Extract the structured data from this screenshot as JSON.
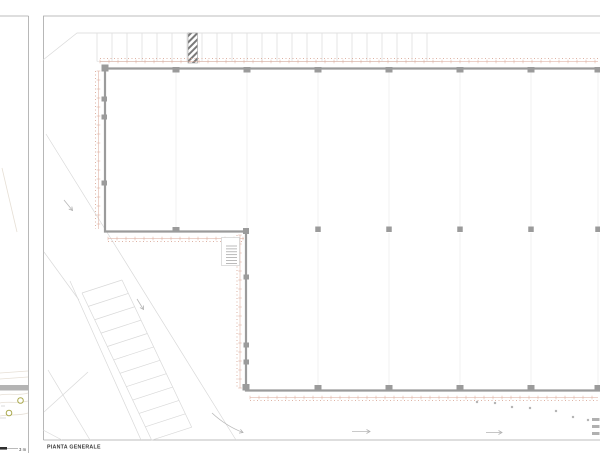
{
  "labels": {
    "title": "PIANTA GENERALE",
    "scale": "3 m"
  },
  "colors": {
    "wall": "#9b9b9b",
    "column": "#9b9b9b",
    "frame": "#a6a6a6",
    "faint": "#d9d9d9",
    "stall": "#dcdcdc",
    "very_faint": "#f1f1f1",
    "dim": "#d9a695",
    "hatch": "#7a7a7a",
    "dot": "#b5b5b5",
    "dash": "#b0b0b0",
    "olive": "#aaa94e",
    "bar": "#b4b4b4",
    "label": "#3a3a3a",
    "contour": "#e6dfd5",
    "arrow": "#b8b8b8",
    "stair": "#9e9e9e"
  },
  "geometry": {
    "grid_x": [
      105,
      176,
      247,
      318,
      389,
      460,
      531,
      598
    ],
    "interior_cols": [
      318,
      389,
      460,
      531,
      598
    ],
    "interior_grid": {
      "upper": [
        176,
        247,
        318,
        389,
        460,
        531,
        598
      ],
      "lower": [
        318,
        389,
        460,
        531,
        598
      ]
    },
    "left_pilasters": [
      99,
      117,
      183
    ],
    "west_pilasters": [
      277,
      345,
      362
    ],
    "top_stalls": {
      "x0": 97,
      "x1": 440,
      "step": 15,
      "y0": 33,
      "y1": 61.5
    },
    "hatch_rect": {
      "x": 188,
      "y": 33,
      "w": 9.5,
      "h": 30
    },
    "dim_lines": [
      {
        "x1": 100,
        "y1": 61.5,
        "x2": 598,
        "y2": 61.5,
        "nx": 0,
        "ny": -1
      },
      {
        "x1": 98.5,
        "y1": 71,
        "x2": 98.5,
        "y2": 229,
        "nx": -1,
        "ny": 0
      },
      {
        "x1": 108,
        "y1": 238.5,
        "x2": 244,
        "y2": 238.5,
        "nx": 0,
        "ny": 1
      },
      {
        "x1": 240,
        "y1": 235,
        "x2": 240,
        "y2": 388,
        "nx": -1,
        "ny": 0
      },
      {
        "x1": 250,
        "y1": 397.5,
        "x2": 598,
        "y2": 397.5,
        "nx": 0,
        "ny": 1
      }
    ],
    "road_lines": [
      [
        46,
        134,
        236,
        440
      ],
      [
        70,
        281,
        141,
        440
      ],
      [
        44,
        252,
        79,
        300
      ],
      [
        48,
        370,
        90,
        440
      ],
      [
        44,
        412,
        88,
        372
      ],
      [
        43,
        430,
        62,
        440
      ]
    ],
    "angled_parking": {
      "x0": 82,
      "y0": 293,
      "ux": 0.428,
      "uy": 0.904,
      "len": 163,
      "step": 14.8,
      "rx": 40,
      "ry": -13
    },
    "dots": [
      [
        477,
        402
      ],
      [
        495,
        403
      ],
      [
        512,
        407
      ],
      [
        530,
        408
      ],
      [
        556,
        411
      ],
      [
        573,
        417
      ],
      [
        588,
        420
      ]
    ],
    "edge_dashes": [
      418,
      425,
      432
    ],
    "stair": {
      "x0": 226,
      "x1": 237,
      "y0": 246,
      "y1": 263.5,
      "step": 2.9
    }
  }
}
